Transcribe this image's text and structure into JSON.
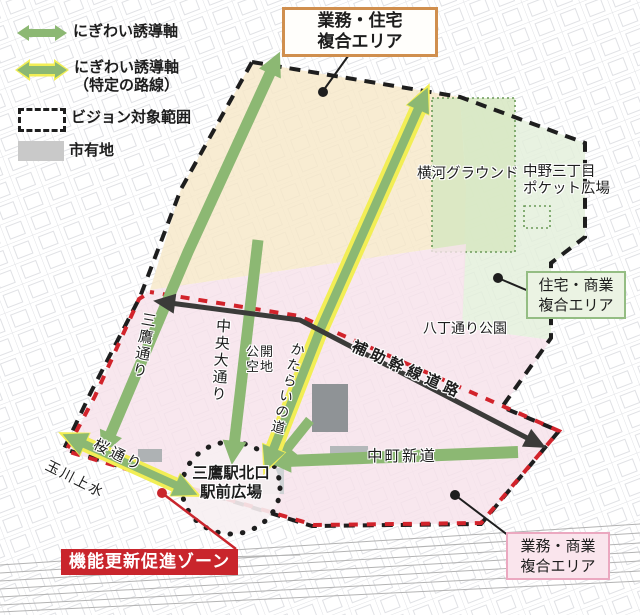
{
  "legend": {
    "axis_label": "にぎわい誘導軸",
    "axis_specific_label": "にぎわい誘導軸\n（特定の路線）",
    "vision_area_label": "ビジョン対象範囲",
    "city_land_label": "市有地"
  },
  "areas": {
    "business_residential": "業務・住宅\n複合エリア",
    "residential_commercial": "住宅・商業\n複合エリア",
    "business_commercial": "業務・商業\n複合エリア",
    "yokogawa_ground": "横河グラウンド",
    "nakano_pocket_plaza": "中野三丁目\nポケット広場",
    "hatcho_dori_park": "八丁通り公園",
    "public_open_space": "公開\n空地",
    "station_plaza": "三鷹駅北口\n駅前広場",
    "renewal_zone": "機能更新促進ゾーン"
  },
  "roads": {
    "auxiliary_trunk_road": "補助幹線道路",
    "mitaka_dori": "三鷹通り",
    "chuo_odori": "中央大通り",
    "katarai_no_michi": "かたらいの道",
    "sakura_dori": "桜通り",
    "tamagawa_josui": "玉川上水",
    "nakacho_shindo": "中町新道"
  },
  "colors": {
    "axis_green": "#8cb873",
    "axis_highlight_yellow": "#f2ee55",
    "vision_boundary_black": "#1e1e1e",
    "renewal_zone_red": "#c9252c",
    "business_residential_fill": "#f7e8c8",
    "residential_commercial_fill": "#e3efdb",
    "yokogawa_ground_fill": "#d7e8c2",
    "business_commercial_fill": "#f6e2ea",
    "city_land_gray": "#c9c9c9",
    "auxiliary_road_black": "#3b3b39"
  }
}
